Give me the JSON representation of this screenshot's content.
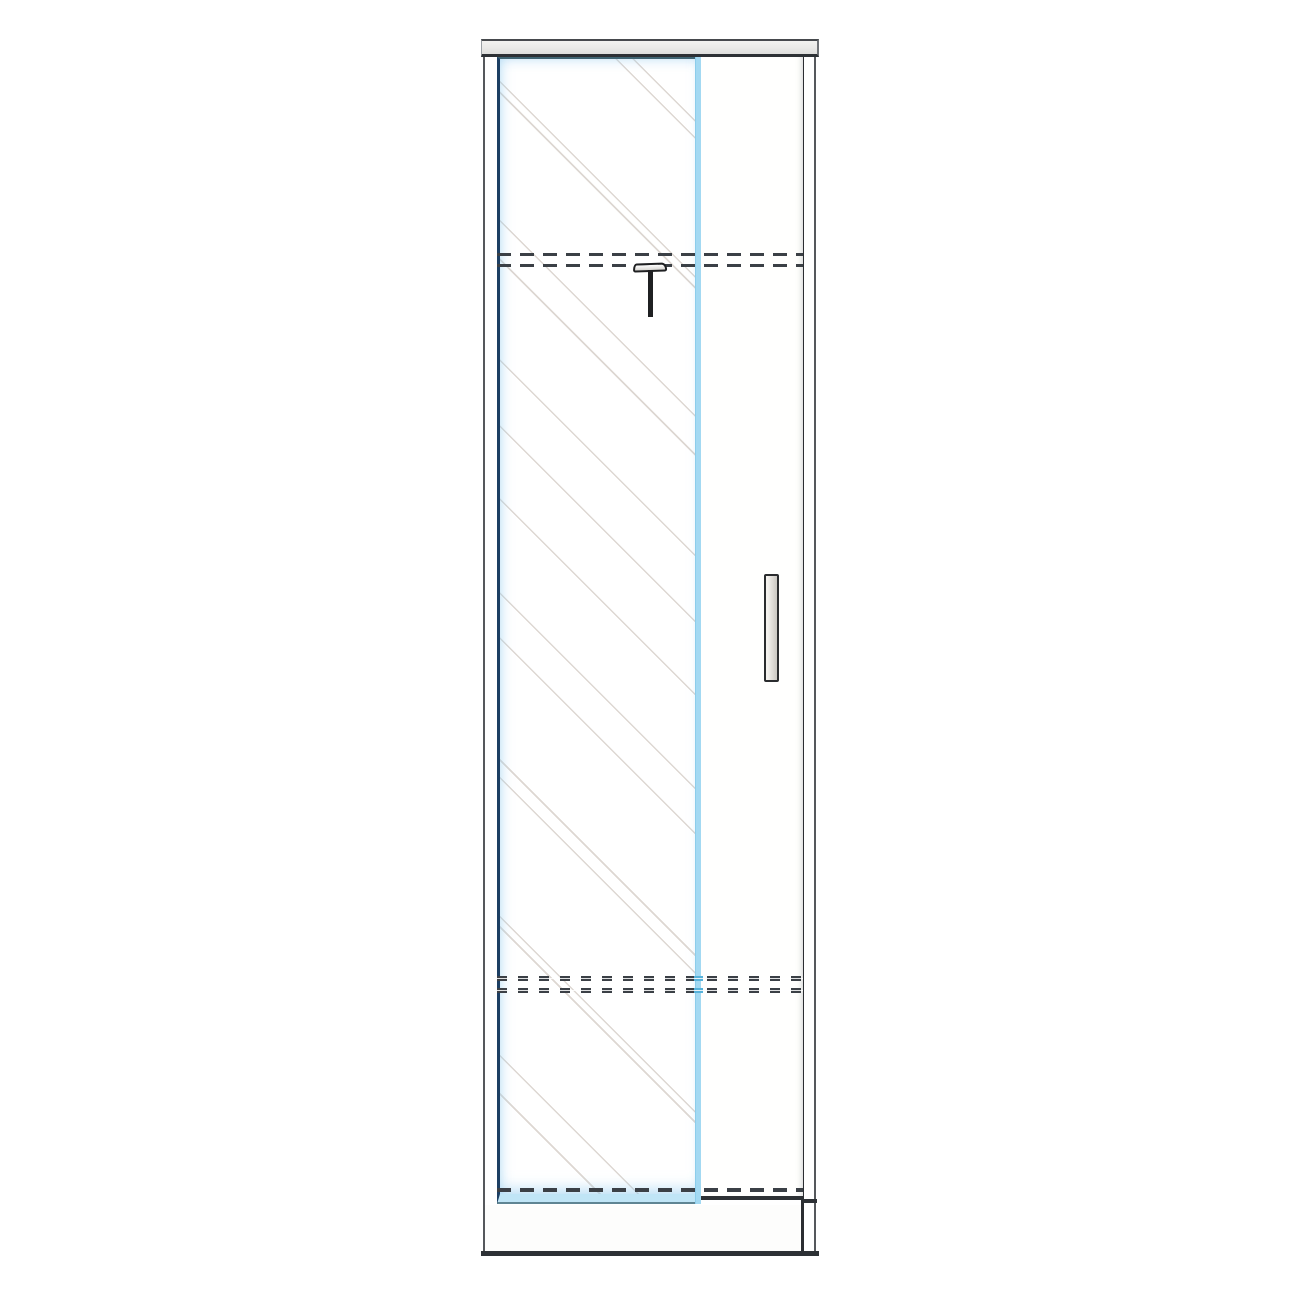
{
  "diagram": {
    "type": "furniture technical drawing",
    "subject": "tall single-section wardrobe, front elevation, mirrored door with hatched glass, hinged door with vertical handle, hidden shelf and plinth lines shown dashed"
  },
  "colors": {
    "page_bg": "#ffffff",
    "outline_dark": "#2d3135",
    "outline_mid": "#55585c",
    "cap_fill": "#e9e9e7",
    "door_edge_navy": "#1d3f63",
    "door_edge_teal": "#3f6472",
    "accent_blue": "#a3d9f2",
    "accent_blue_light": "#c0e5f6",
    "accent_blue_dark": "#57b2da",
    "dash": "#3b4046",
    "hatch": "#ddd7d2",
    "handle_edge": "#2a2c2e",
    "handle_fill_light": "#f4f2ee",
    "handle_fill_dark": "#ccc9c3",
    "hook": "#1f2022"
  }
}
